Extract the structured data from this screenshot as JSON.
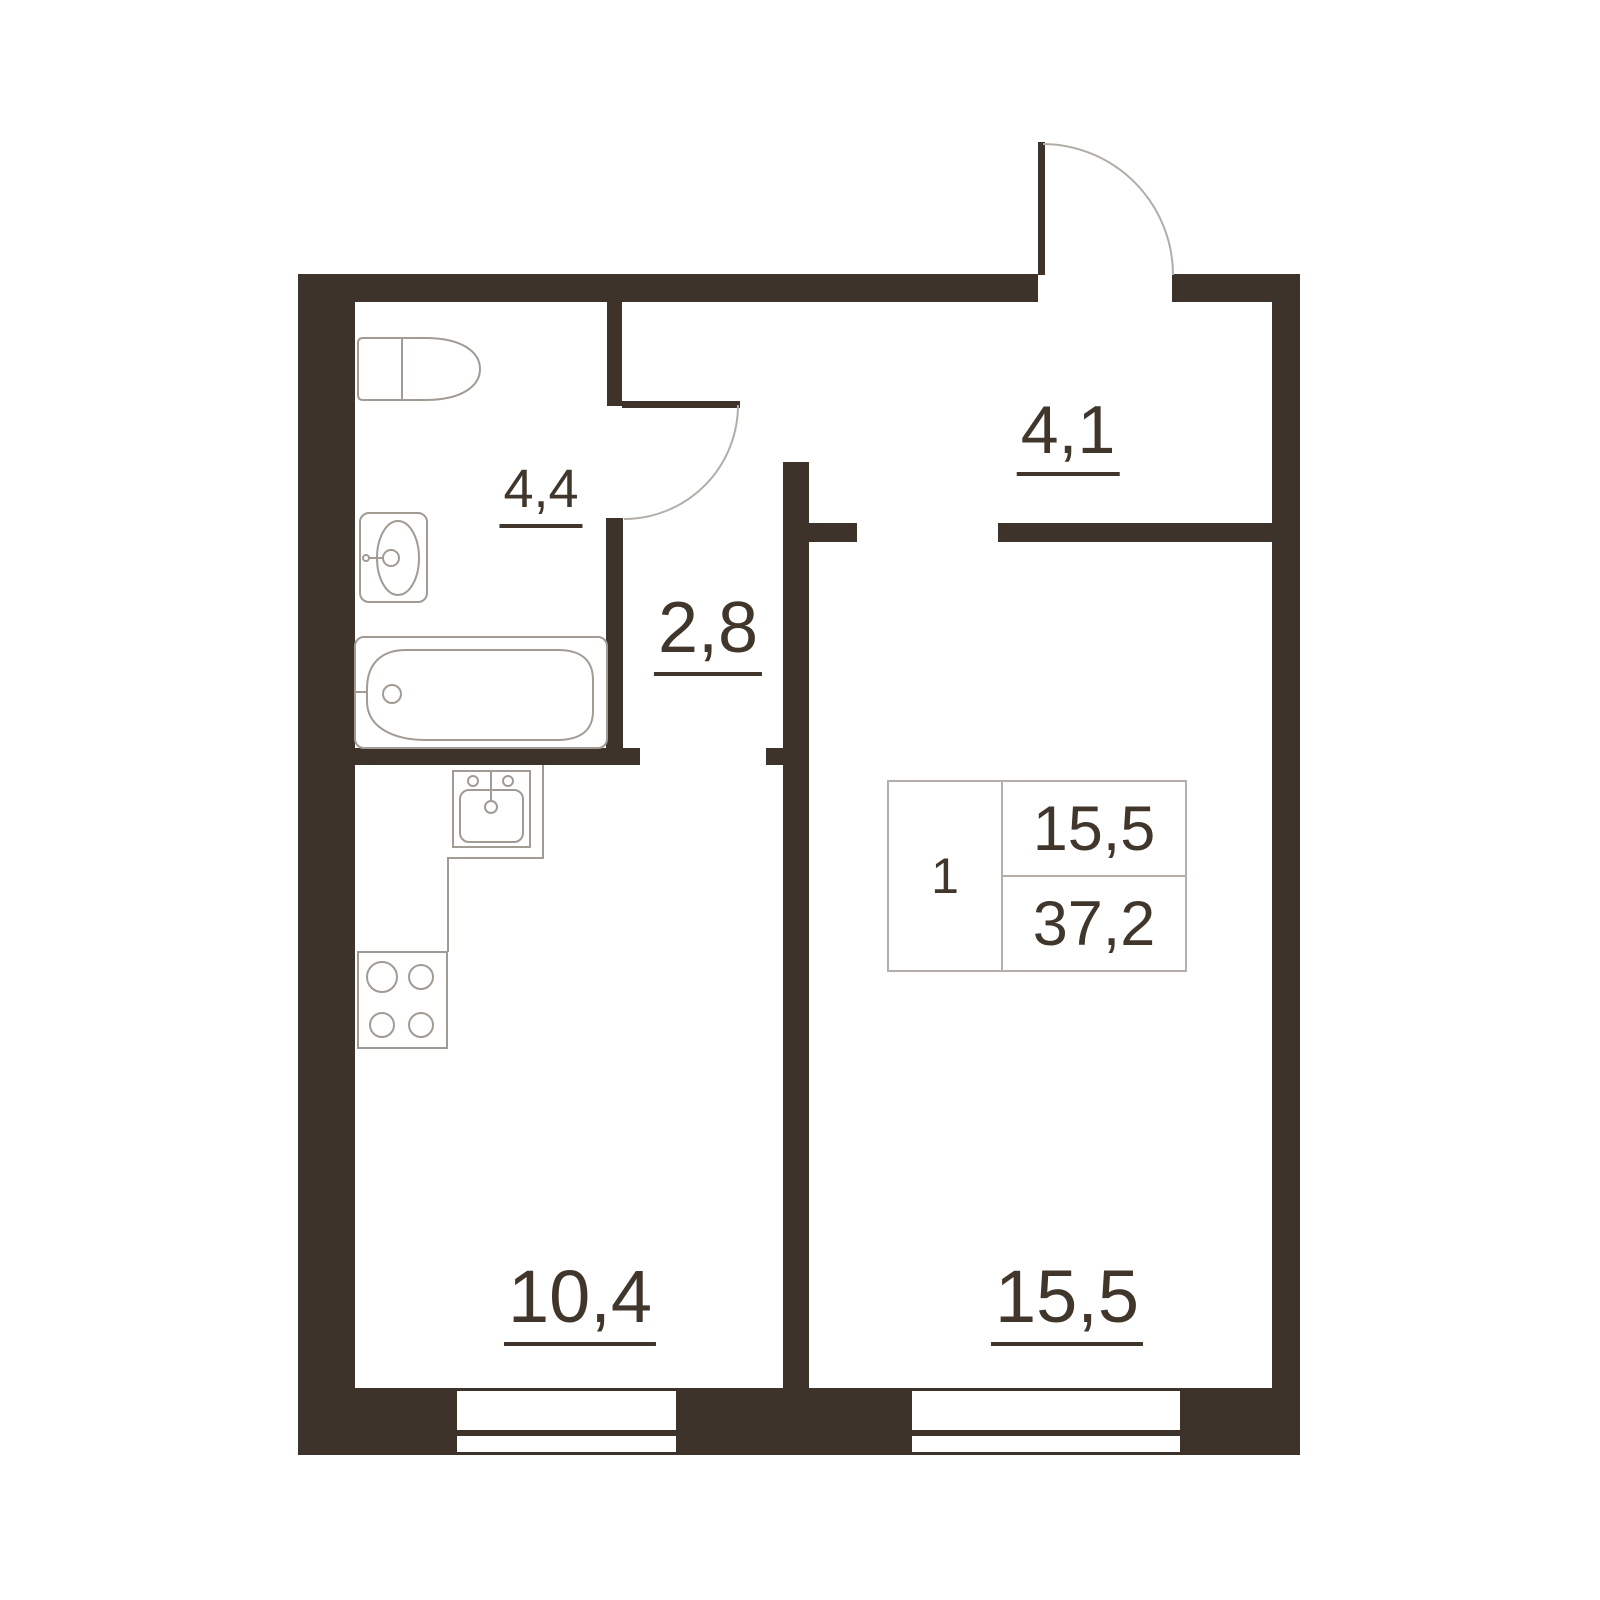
{
  "floor_plan": {
    "background_color": "#ffffff",
    "wall_color": "#3e332b",
    "fixture_line_color": "#a29b94",
    "door_arc_color": "#b3ada7",
    "text_color": "#41362b",
    "table_border_color": "#b6afa9",
    "unit_info": {
      "rooms_count": "1",
      "living_area": "15,5",
      "total_area": "37,2"
    },
    "room_areas": {
      "bathroom": "4,4",
      "hallway": "2,8",
      "entrance_hall": "4,1",
      "kitchen": "10,4",
      "living_room": "15,5"
    },
    "fixtures": [
      "toilet",
      "washbasin",
      "bathtub",
      "kitchen-sink",
      "stove",
      "kitchen-counter"
    ],
    "doors": [
      "entrance-door",
      "bathroom-door"
    ],
    "windows": [
      "kitchen-window",
      "living-room-window"
    ]
  }
}
